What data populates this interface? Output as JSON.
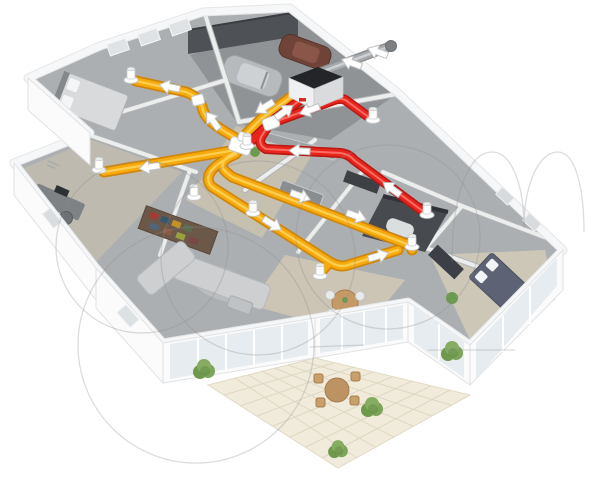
{
  "scene": {
    "type": "3d-cutaway-illustration",
    "subject": "house mechanical ventilation system with heat recovery",
    "background_color": "#ffffff",
    "supply_air": {
      "duct_color": "#f6aa0c",
      "vent_count": 6,
      "arrow_color": "#ffffff"
    },
    "extract_air": {
      "duct_color": "#e8251d",
      "vent_count": 3,
      "arrow_color": "#ffffff"
    },
    "outdoor_air_duct": {
      "color": "#a3a6a8",
      "location": "through exterior wall near unit"
    },
    "equipment": [
      "heat-recovery-ventilation-unit",
      "supply-duct-network",
      "extract-duct-network",
      "ceiling-vents",
      "duct-manifold",
      "outdoor-air-duct"
    ],
    "rooms": [
      "garage",
      "bedroom",
      "home-office",
      "hallway",
      "living-room",
      "kitchen",
      "dining-area",
      "bathroom",
      "bedroom-2",
      "patio"
    ],
    "palette": {
      "floor": "#acafb1",
      "wood_floor": "#c9c2b1",
      "walls": "#f6f7f8",
      "garage_wall": "#4e5156",
      "patio_tiles": "#f1ebdb",
      "bushes": "#7ca45a",
      "unit_top": "#232528",
      "car_gray": "#b7babc",
      "car_brown": "#6f4337",
      "bed_dark": "#5d6375",
      "watermark": "#8a8a8a"
    }
  }
}
